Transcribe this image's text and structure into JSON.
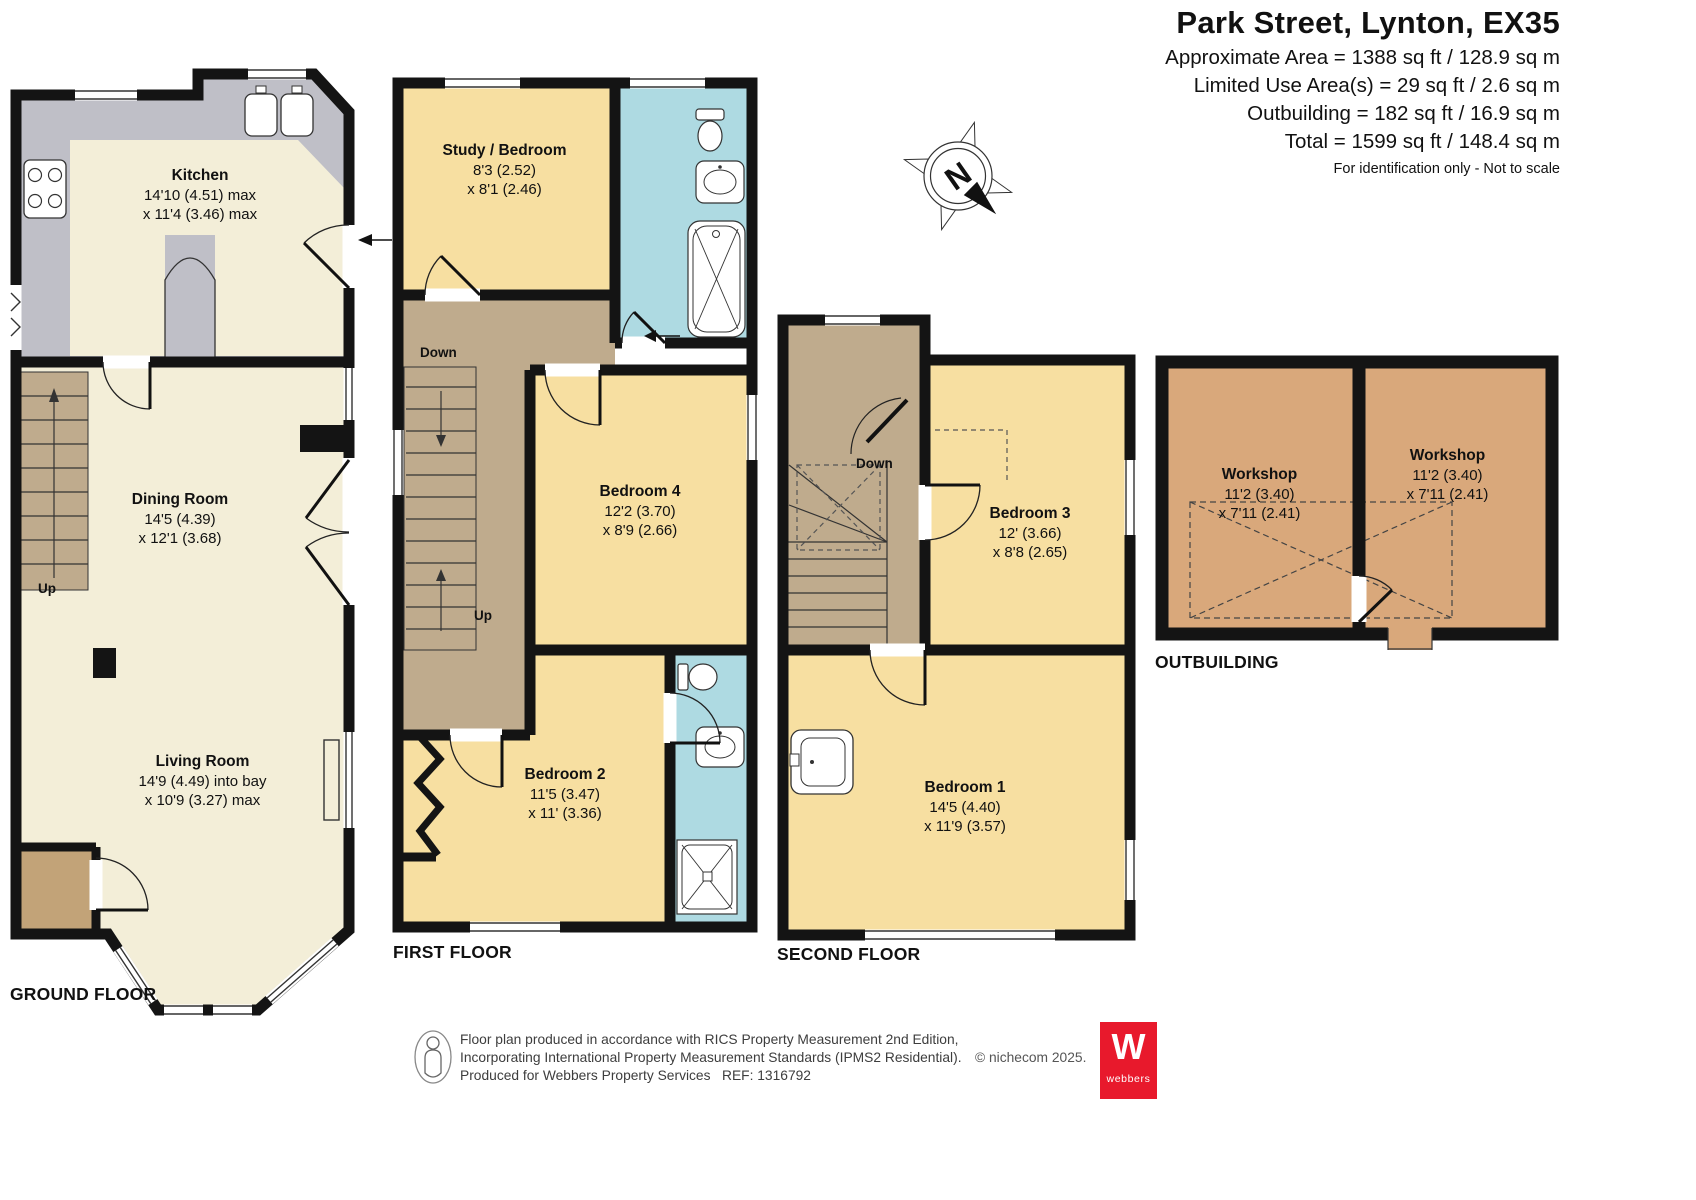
{
  "header": {
    "title": "Park Street, Lynton, EX35",
    "area_lines": [
      "Approximate Area = 1388 sq ft / 128.9 sq m",
      "Limited Use Area(s) = 29 sq ft / 2.6 sq m",
      "Outbuilding = 182 sq ft / 16.9 sq m",
      "Total = 1599 sq ft / 148.4 sq m"
    ],
    "note": "For identification only - Not to scale"
  },
  "compass": {
    "north_label": "N"
  },
  "floors": {
    "ground": {
      "label": "GROUND FLOOR",
      "stair_up_label": "Up",
      "rooms": {
        "kitchen": {
          "name": "Kitchen",
          "dims": "14'10 (4.51) max\nx 11'4 (3.46) max"
        },
        "dining_room": {
          "name": "Dining Room",
          "dims": "14'5 (4.39)\nx 12'1 (3.68)"
        },
        "living_room": {
          "name": "Living Room",
          "dims": "14'9 (4.49) into bay\nx 10'9 (3.27) max"
        }
      }
    },
    "first": {
      "label": "FIRST FLOOR",
      "stair_down_label": "Down",
      "stair_up_label": "Up",
      "rooms": {
        "study_bedroom": {
          "name": "Study / Bedroom",
          "dims": "8'3 (2.52)\nx 8'1 (2.46)"
        },
        "bedroom_4": {
          "name": "Bedroom 4",
          "dims": "12'2 (3.70)\nx 8'9 (2.66)"
        },
        "bedroom_2": {
          "name": "Bedroom 2",
          "dims": "11'5 (3.47)\nx 11' (3.36)"
        }
      }
    },
    "second": {
      "label": "SECOND FLOOR",
      "stair_down_label": "Down",
      "rooms": {
        "bedroom_3": {
          "name": "Bedroom 3",
          "dims": "12' (3.66)\nx 8'8 (2.65)"
        },
        "bedroom_1": {
          "name": "Bedroom 1",
          "dims": "14'5 (4.40)\nx 11'9 (3.57)"
        }
      }
    },
    "outbuilding": {
      "label": "OUTBUILDING",
      "rooms": {
        "workshop_left": {
          "name": "Workshop",
          "dims": "11'2 (3.40)\nx 7'11 (2.41)"
        },
        "workshop_right": {
          "name": "Workshop",
          "dims": "11'2 (3.40)\nx 7'11 (2.41)"
        }
      }
    }
  },
  "footer": {
    "line1": "Floor plan produced in accordance with RICS Property Measurement 2nd Edition,",
    "line2": "Incorporating International Property Measurement Standards (IPMS2 Residential).",
    "line3": "Produced for Webbers Property Services   REF: 1316792",
    "copyright": "© nichecom 2025.",
    "logo": {
      "letter": "W",
      "name": "webbers"
    }
  },
  "colors": {
    "room_cream": "#f3eed8",
    "room_wheat": "#f7dfa1",
    "bathroom_blue": "#aedae2",
    "hall_tan": "#bfab8d",
    "porch_tan": "#c2a378",
    "outbuilding_tan": "#d9a87b",
    "kitchen_gray": "#bfbfc7",
    "wall_black": "#141414",
    "logo_red": "#e8192c"
  }
}
